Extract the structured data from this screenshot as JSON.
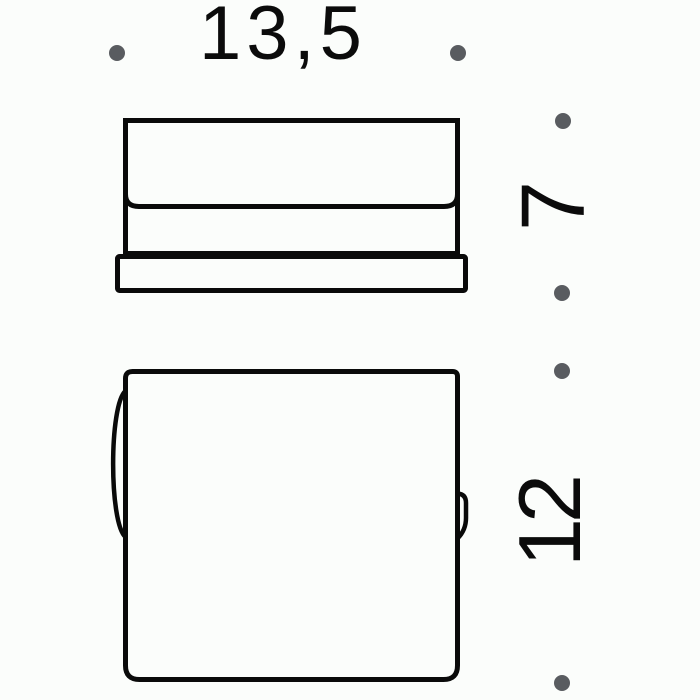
{
  "colors": {
    "background": "#fbfdfb",
    "line": "#0a0a0a",
    "dot": "#595c60",
    "text": "#0b0b0b"
  },
  "diagram": {
    "kind": "technical-dimension-drawing",
    "views": [
      {
        "id": "side-view",
        "description": "profile view of cover on base plate"
      },
      {
        "id": "front-view",
        "description": "front view with hinge bulge and latch tab"
      }
    ],
    "dimensions": {
      "width_label": "13,5",
      "side_height_label": "7",
      "front_height_label": "12"
    }
  }
}
